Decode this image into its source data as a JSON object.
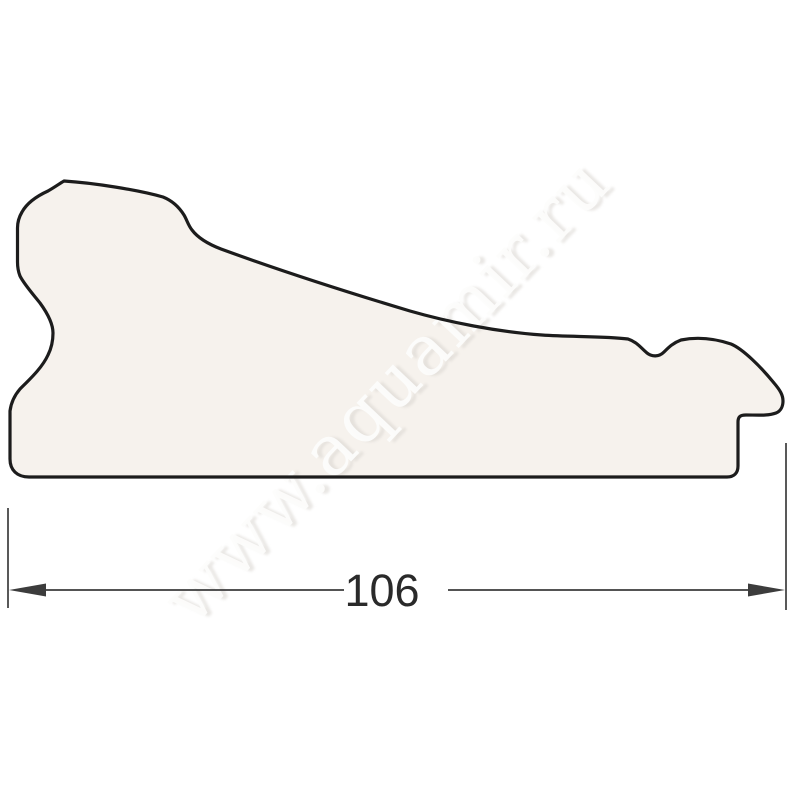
{
  "drawing": {
    "type": "moulding-profile-cross-section",
    "watermark": {
      "text": "www.aquamir.ru"
    },
    "dimension": {
      "value": "106"
    },
    "colors": {
      "background": "#ffffff",
      "shape_fill": "#f6f2ed",
      "outline": "#1c1c1c",
      "dimension_lines": "#3c3c3c",
      "dimension_text": "#2a2a2a",
      "watermark_text": "#fdfdfc",
      "watermark_shadow": "#d8d4cf"
    }
  }
}
